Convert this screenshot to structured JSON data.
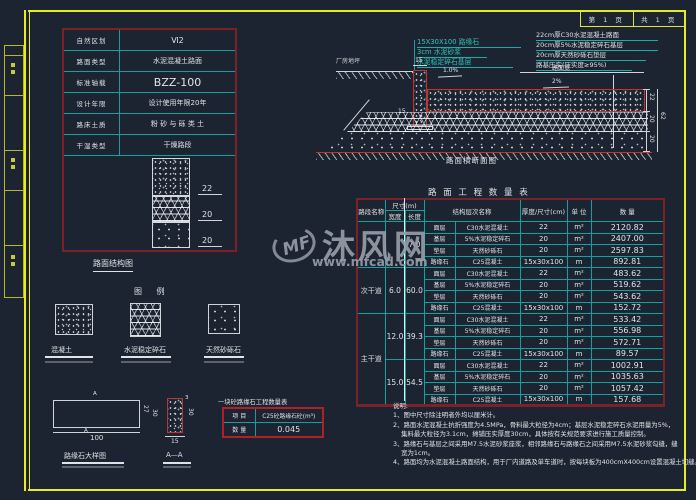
{
  "frame": {
    "page_cell_left": "第 1 页",
    "page_cell_right": "共 1 页"
  },
  "spec_table": {
    "rows": [
      {
        "label": "自然区划",
        "value": "Ⅵ2"
      },
      {
        "label": "路面类型",
        "value": "水泥混凝土路面"
      },
      {
        "label": "标准轴载",
        "value": "BZZ-100"
      },
      {
        "label": "设计年限",
        "value": "设计使用年限20年"
      },
      {
        "label": "路床土质",
        "value": "粉 砂 与 砾 类 土"
      },
      {
        "label": "干湿类型",
        "value": "干燥路段"
      }
    ],
    "dims": [
      "22",
      "20",
      "20"
    ],
    "caption": "路面结构图"
  },
  "cross_section": {
    "ground_label": "厂房地坪",
    "curb_notes": [
      "15X30X100 路缘石",
      "3cm 水泥砂浆",
      "水泥稳定碎石基层"
    ],
    "layer_notes": [
      "22cm厚C30水泥混凝土路面",
      "20cm厚5%水泥稳定碎石基层",
      "20cm厚天然砂砾石垫层",
      "路基压实(压实度≥95%)"
    ],
    "dim_curb_top": "15",
    "dim_curb_left": "15",
    "slope_inner": "1.0%",
    "slope_main": "2%",
    "span_label": "路面宽",
    "dims_right": [
      "22",
      "20",
      "20"
    ],
    "dim_total": "62",
    "caption": "路面横断面图"
  },
  "quantity_table": {
    "title": "路 面 工 程 数 量 表",
    "headers": {
      "section": "路段名称",
      "size": "尺寸(m)",
      "width": "宽度",
      "length": "长度",
      "structure": "结构层次名称",
      "thickness": "厚度/尺寸(cm)",
      "unit": "单  位",
      "quantity": "数  量"
    },
    "groups": [
      {
        "section": "",
        "section_rowspan": 4,
        "width": "",
        "length": "7.0",
        "rows": [
          {
            "layer": "面层",
            "material": "C30水泥混凝土",
            "size": "22",
            "unit": "m²",
            "qty": "2120.82"
          },
          {
            "layer": "基层",
            "material": "5%水泥稳定碎石",
            "size": "20",
            "unit": "m²",
            "qty": "2407.00"
          },
          {
            "layer": "垫层",
            "material": "天然砂砾石",
            "size": "20",
            "unit": "m²",
            "qty": "2597.83"
          },
          {
            "layer": "路缘石",
            "material": "C25混凝土",
            "size": "15x30x100",
            "unit": "m",
            "qty": "892.81"
          }
        ]
      },
      {
        "section": "次干道",
        "section_rowspan": 4,
        "width": "6.0",
        "length": "60.0",
        "rows": [
          {
            "layer": "面层",
            "material": "C30水泥混凝土",
            "size": "22",
            "unit": "m²",
            "qty": "483.62"
          },
          {
            "layer": "基层",
            "material": "5%水泥稳定碎石",
            "size": "20",
            "unit": "m²",
            "qty": "519.62"
          },
          {
            "layer": "垫层",
            "material": "天然砂砾石",
            "size": "20",
            "unit": "m²",
            "qty": "543.62"
          },
          {
            "layer": "路缘石",
            "material": "C25混凝土",
            "size": "15x30x100",
            "unit": "m",
            "qty": "152.72"
          }
        ]
      },
      {
        "section": "主干道",
        "section_rowspan": 8,
        "width": "12.0",
        "length": "39.3",
        "rows": [
          {
            "layer": "面层",
            "material": "C30水泥混凝土",
            "size": "22",
            "unit": "m²",
            "qty": "533.42"
          },
          {
            "layer": "基层",
            "material": "5%水泥稳定碎石",
            "size": "20",
            "unit": "m²",
            "qty": "556.98"
          },
          {
            "layer": "垫层",
            "material": "天然砂砾石",
            "size": "20",
            "unit": "m²",
            "qty": "572.71"
          },
          {
            "layer": "路缘石",
            "material": "C25混凝土",
            "size": "15x30x100",
            "unit": "m",
            "qty": "89.57"
          }
        ]
      },
      {
        "section": null,
        "section_rowspan": 0,
        "width": "15.0",
        "length": "54.5",
        "rows": [
          {
            "layer": "面层",
            "material": "C30水泥混凝土",
            "size": "22",
            "unit": "m²",
            "qty": "1002.91"
          },
          {
            "layer": "基层",
            "material": "5%水泥稳定碎石",
            "size": "20",
            "unit": "m²",
            "qty": "1035.63"
          },
          {
            "layer": "垫层",
            "material": "天然砂砾石",
            "size": "20",
            "unit": "m²",
            "qty": "1057.42"
          },
          {
            "layer": "路缘石",
            "material": "C25混凝土",
            "size": "15x30x100",
            "unit": "m",
            "qty": "157.68"
          }
        ]
      }
    ]
  },
  "legend": {
    "title": "图  例",
    "items": [
      {
        "label": "混凝土"
      },
      {
        "label": "水泥稳定碎石"
      },
      {
        "label": "天然砂砾石"
      }
    ]
  },
  "curb_detail": {
    "caption_elevation": "路缘石大样图",
    "caption_section": "A—A",
    "marker": "A",
    "dim_length": "100",
    "dim_h_inner": "27",
    "dim_h_outer": "30",
    "dim_sec_h": "30",
    "dim_sec_w": "15",
    "dim_sec_chamfer": "3",
    "mini_table": {
      "title": "一块砼路缘石工程数量表",
      "row1_label": "项  目",
      "row1_value": "C25砼路缘石砼(m³)",
      "row2_label": "数  量",
      "row2_value": "0.045"
    }
  },
  "notes": {
    "lines": [
      "说明:",
      "1、图中尺寸除注明者外均以厘米计。",
      "2、路面水泥混凝土抗折强度为4.5MPa，骨料最大粒径为4cm；基层水泥稳定碎石水泥用量为5%，",
      "    集料最大粒径为3.1cm，摊铺压实厚度30cm，具体按有关规范要求进行施工质量控制。",
      "3、路缘石与基层之间采用M7.5水泥砂浆座浆，相邻路缘石与路缘石之间采用M7.5水泥砂浆勾缝，缝",
      "    宽为1cm。",
      "4、路面均为水泥混凝土路面结构，用于厂内道路及单车道时，按每块板为400cmX400cm设置混凝土切缝。"
    ]
  },
  "watermark": {
    "logo": "MF",
    "name": "沐风网",
    "url": "www.mfcad.com"
  },
  "colors": {
    "background": "#1d2431",
    "frame_yellow": "#e8eb1e",
    "grid_teal": "#0fa3a0",
    "border_dark_red": "#7c2125",
    "diagram_red": "#c23430",
    "text_white": "#dfe3e6",
    "watermark_gray": "#969da8"
  }
}
